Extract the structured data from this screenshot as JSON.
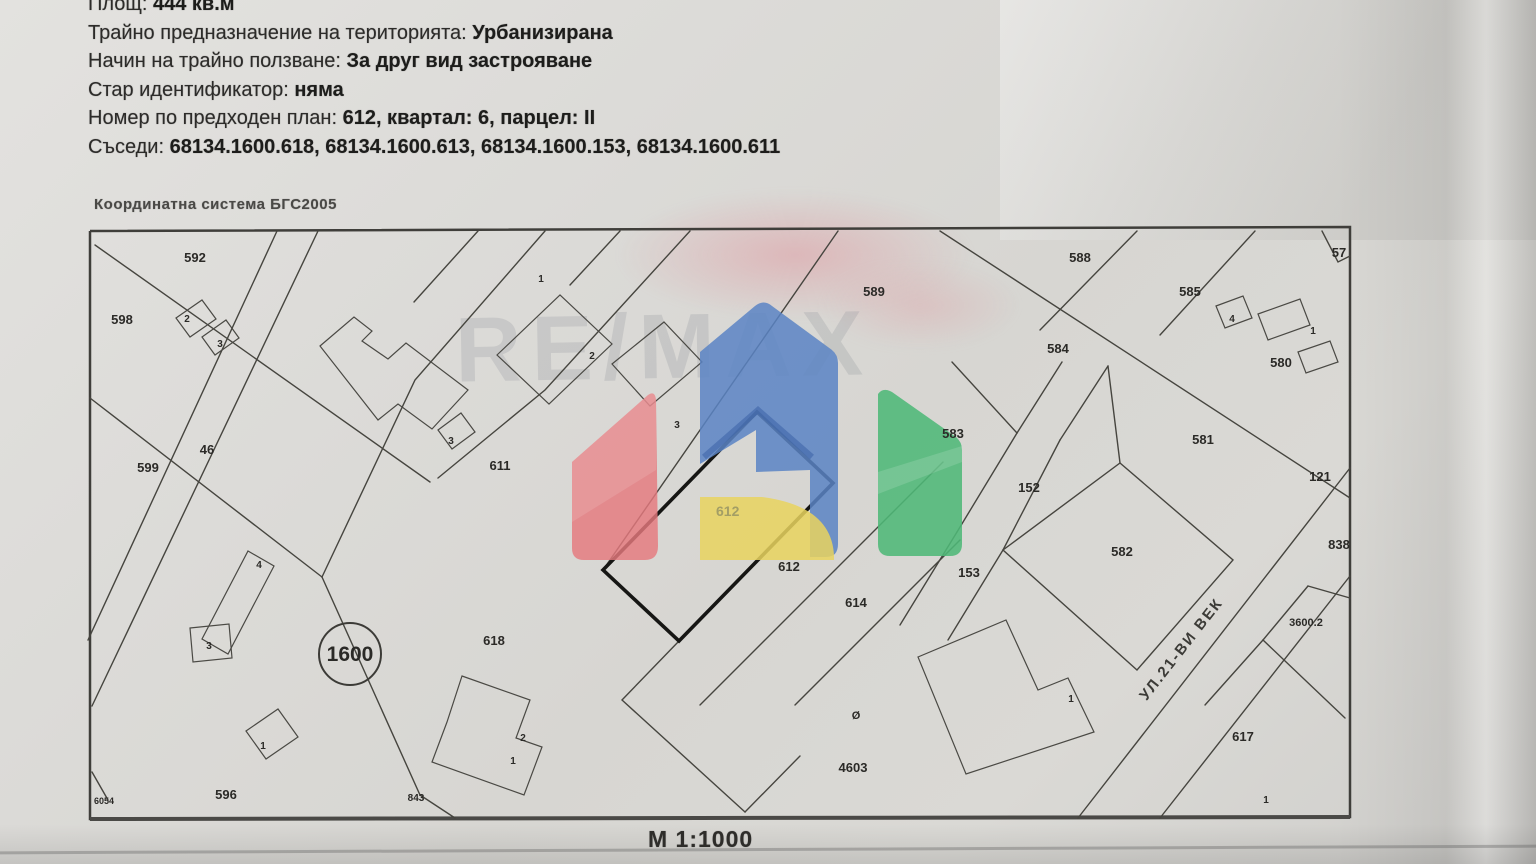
{
  "document": {
    "header_lines": [
      {
        "label": "Площ:",
        "value": "444 кв.м"
      },
      {
        "label": "Трайно предназначение на територията:",
        "value": "Урбанизирана"
      },
      {
        "label": "Начин на трайно ползване:",
        "value": "За друг вид застрояване"
      },
      {
        "label": "Стар идентификатор:",
        "value": "няма"
      },
      {
        "label": "Номер по предходен план:",
        "value": "612, квартал: 6, парцел: II"
      },
      {
        "label": "Съседи:",
        "value": "68134.1600.618, 68134.1600.613, 68134.1600.153, 68134.1600.611"
      }
    ],
    "coordinate_system": "Координатна система БГС2005",
    "scale": "М 1:1000"
  },
  "map": {
    "street_label": "УЛ.21-ВИ ВЕК",
    "subject_parcel": "612",
    "circled_label": "1600",
    "labels": [
      {
        "t": "592",
        "x": 195,
        "y": 262
      },
      {
        "t": "598",
        "x": 122,
        "y": 324
      },
      {
        "t": "2",
        "x": 187,
        "y": 322,
        "s": 10
      },
      {
        "t": "3",
        "x": 220,
        "y": 347,
        "s": 10
      },
      {
        "t": "599",
        "x": 148,
        "y": 472
      },
      {
        "t": "46",
        "x": 207,
        "y": 454
      },
      {
        "t": "611",
        "x": 500,
        "y": 470
      },
      {
        "t": "3",
        "x": 451,
        "y": 444,
        "s": 10
      },
      {
        "t": "1",
        "x": 541,
        "y": 282,
        "s": 10
      },
      {
        "t": "2",
        "x": 592,
        "y": 359,
        "s": 10
      },
      {
        "t": "3",
        "x": 677,
        "y": 428,
        "s": 10
      },
      {
        "t": "589",
        "x": 874,
        "y": 296
      },
      {
        "t": "588",
        "x": 1080,
        "y": 262
      },
      {
        "t": "585",
        "x": 1190,
        "y": 296
      },
      {
        "t": "57",
        "x": 1339,
        "y": 257
      },
      {
        "t": "584",
        "x": 1058,
        "y": 353
      },
      {
        "t": "4",
        "x": 1232,
        "y": 322,
        "s": 10
      },
      {
        "t": "1",
        "x": 1313,
        "y": 334,
        "s": 10
      },
      {
        "t": "580",
        "x": 1281,
        "y": 367
      },
      {
        "t": "583",
        "x": 953,
        "y": 438
      },
      {
        "t": "581",
        "x": 1203,
        "y": 444
      },
      {
        "t": "121",
        "x": 1320,
        "y": 481
      },
      {
        "t": "152",
        "x": 1029,
        "y": 492
      },
      {
        "t": "582",
        "x": 1122,
        "y": 556
      },
      {
        "t": "153",
        "x": 969,
        "y": 577
      },
      {
        "t": "838",
        "x": 1339,
        "y": 549
      },
      {
        "t": "3600.2",
        "x": 1306,
        "y": 626,
        "s": 11
      },
      {
        "t": "617",
        "x": 1243,
        "y": 741
      },
      {
        "t": "1",
        "x": 1266,
        "y": 803,
        "s": 10
      },
      {
        "t": "612",
        "x": 789,
        "y": 571
      },
      {
        "t": "614",
        "x": 856,
        "y": 607
      },
      {
        "t": "4603",
        "x": 853,
        "y": 772
      },
      {
        "t": "Ø",
        "x": 856,
        "y": 719,
        "s": 11
      },
      {
        "t": "618",
        "x": 494,
        "y": 645
      },
      {
        "t": "4",
        "x": 259,
        "y": 568,
        "s": 10
      },
      {
        "t": "3",
        "x": 209,
        "y": 649,
        "s": 10
      },
      {
        "t": "1",
        "x": 263,
        "y": 749,
        "s": 10
      },
      {
        "t": "596",
        "x": 226,
        "y": 799
      },
      {
        "t": "6054",
        "x": 104,
        "y": 804,
        "s": 9
      },
      {
        "t": "843",
        "x": 416,
        "y": 801,
        "s": 10
      },
      {
        "t": "2",
        "x": 523,
        "y": 741,
        "s": 10
      },
      {
        "t": "1",
        "x": 513,
        "y": 764,
        "s": 10
      },
      {
        "t": "1",
        "x": 1071,
        "y": 702,
        "s": 10
      }
    ],
    "faint_parcel_label": {
      "t": "612",
      "x": 716,
      "y": 516
    }
  },
  "watermark": {
    "brand_text": "RE/MAX",
    "colors": {
      "red": "#e5797e",
      "blue": "#5b84c4",
      "yellow": "#e9d35e",
      "green": "#4fb878"
    }
  }
}
